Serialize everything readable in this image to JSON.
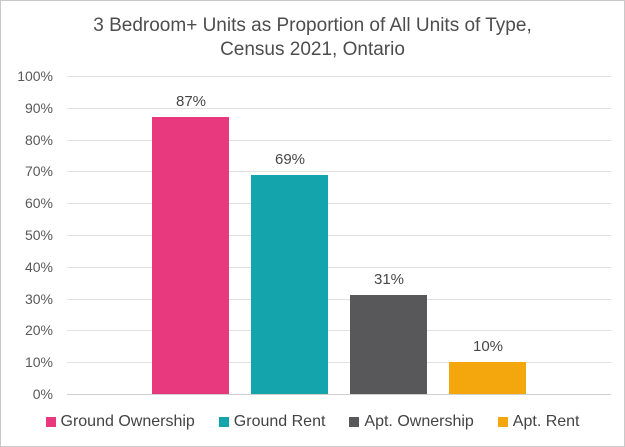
{
  "title": {
    "line1": "3 Bedroom+ Units as Proportion of All Units of Type,",
    "line2": "Census 2021, Ontario"
  },
  "chart_data": {
    "type": "bar",
    "title": "3 Bedroom+ Units as Proportion of All Units of Type, Census 2021, Ontario",
    "categories": [
      "Ground Ownership",
      "Ground Rent",
      "Apt. Ownership",
      "Apt. Rent"
    ],
    "values": [
      87,
      69,
      31,
      10
    ],
    "value_labels": [
      "87%",
      "69%",
      "31%",
      "10%"
    ],
    "bar_colors": [
      "#e8397f",
      "#14a5ac",
      "#58575a",
      "#f3a70d"
    ],
    "xlabel": "",
    "ylabel": "",
    "ylim": [
      0,
      100
    ],
    "ytick_step": 10,
    "ytick_labels": [
      "0%",
      "10%",
      "20%",
      "30%",
      "40%",
      "50%",
      "60%",
      "70%",
      "80%",
      "90%",
      "100%"
    ],
    "grid": true,
    "legend_position": "bottom"
  },
  "legend": {
    "items": [
      {
        "label": "Ground Ownership",
        "color": "#e8397f"
      },
      {
        "label": "Ground Rent",
        "color": "#14a5ac"
      },
      {
        "label": "Apt. Ownership",
        "color": "#58575a"
      },
      {
        "label": "Apt. Rent",
        "color": "#f3a70d"
      }
    ]
  },
  "colors": {
    "title_text": "#4d4d4d",
    "axis_text": "#595959",
    "gridline": "#e2e2e2",
    "axis_line": "#cfcfcf",
    "frame_border": "#c9c9c9",
    "background": "#ffffff"
  }
}
